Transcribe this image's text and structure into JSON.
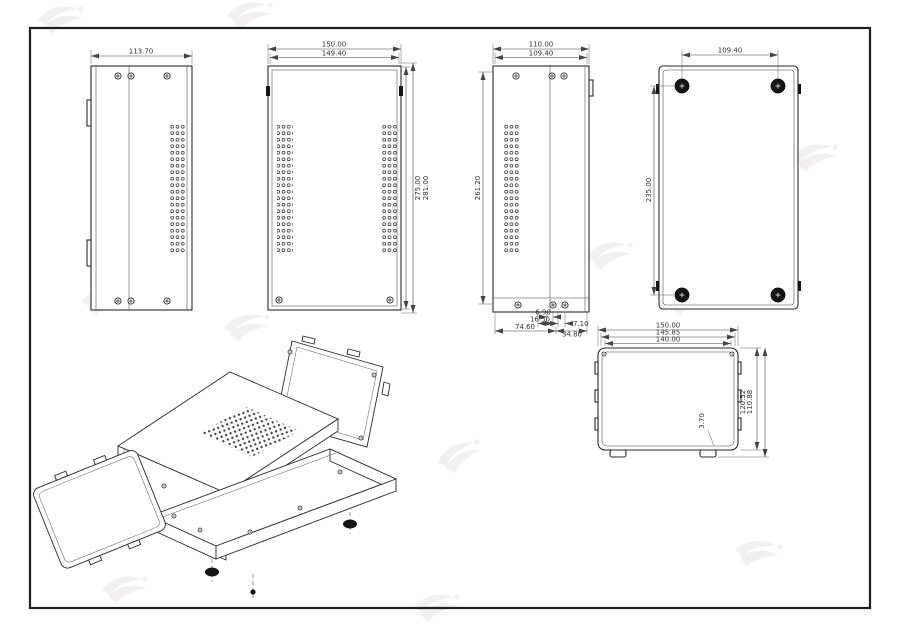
{
  "colors": {
    "background": "#ffffff",
    "line": "#2b2b2b",
    "watermark": "#b3a89f"
  },
  "dims": {
    "side_left": {
      "width": "113.70"
    },
    "front": {
      "width_outer": "150.00",
      "width_inner": "149.40",
      "height_inner": "275.00",
      "height_outer": "281.00"
    },
    "side_right": {
      "width_outer": "110.00",
      "width_inner": "109.40",
      "height": "261.20",
      "bottom_offset_1": "6.90",
      "bottom_offset_2": "16.50",
      "bottom_offset_3": "7.10",
      "bottom_span_left": "74.60",
      "bottom_span_right": "34.80"
    },
    "back": {
      "feet_span_horizontal": "109.40",
      "feet_span_vertical": "235.00"
    },
    "cover_panel": {
      "width_outer": "150.00",
      "width_mid": "145.85",
      "width_inner": "140.00",
      "height_outer": "120.52",
      "height_inner": "110.88",
      "thickness": "3.70"
    }
  }
}
